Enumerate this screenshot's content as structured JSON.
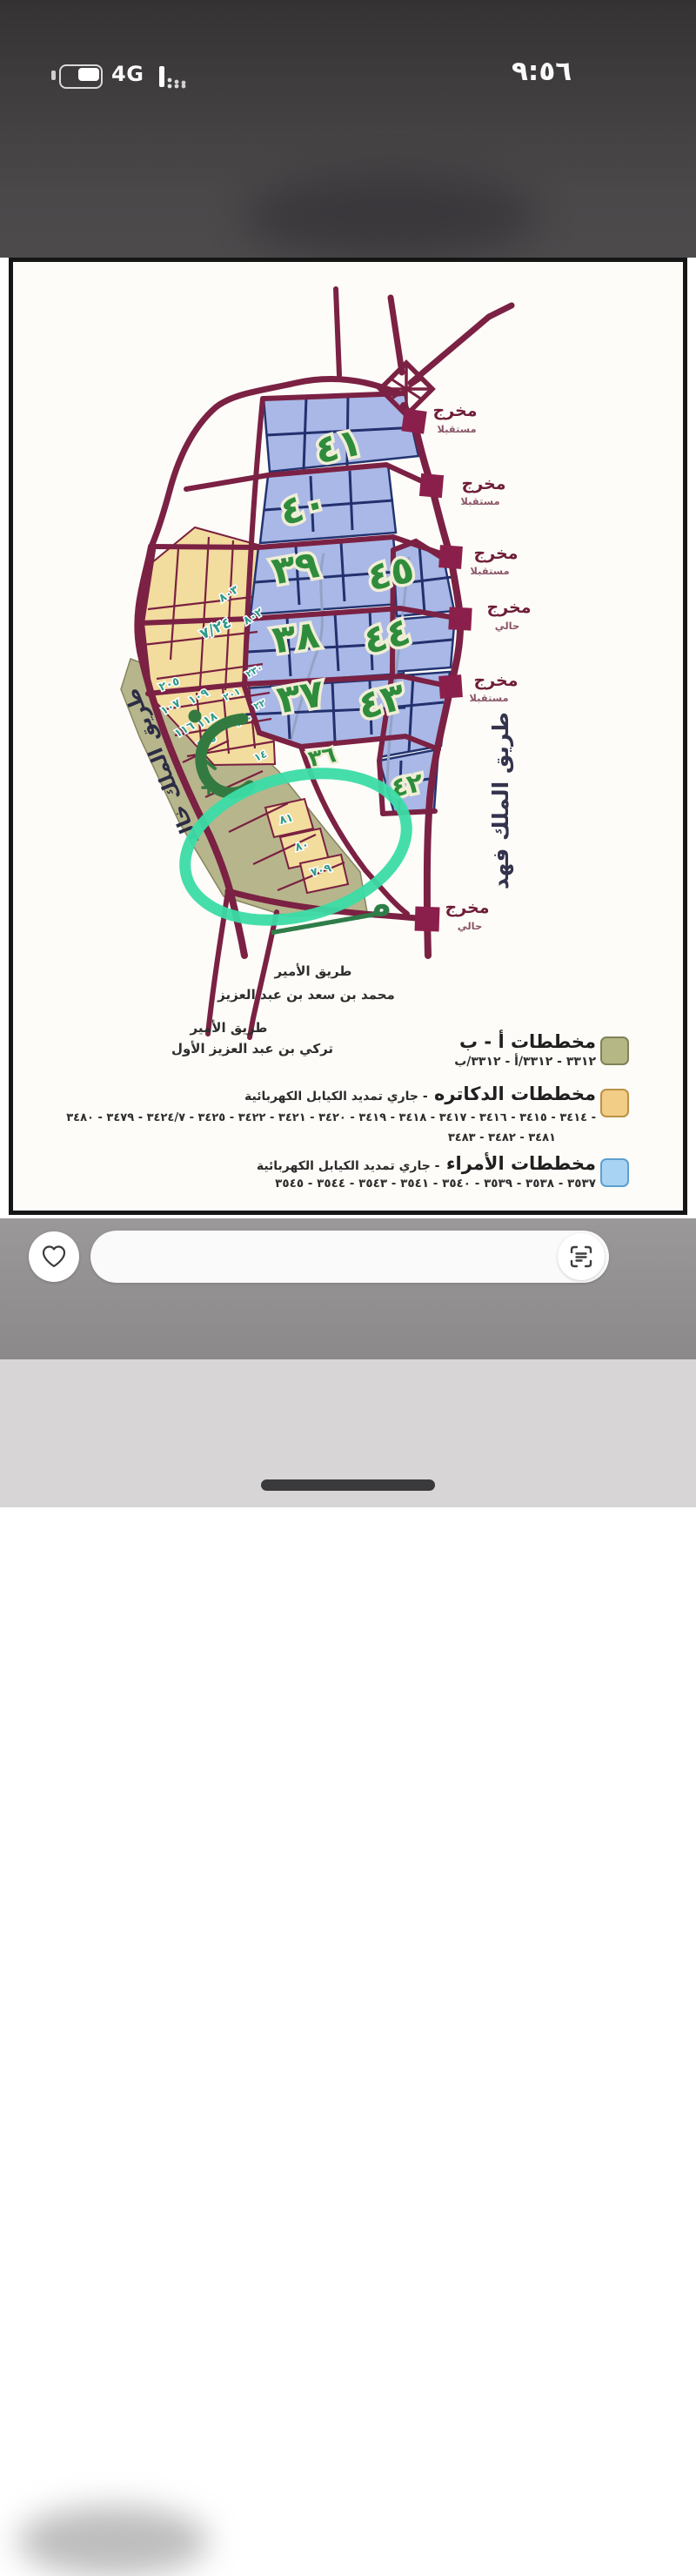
{
  "status_bar": {
    "time": "٩:٥٦",
    "network_label": "4G"
  },
  "map": {
    "exits": [
      {
        "label": "مخرج",
        "sub": "مستقبلا"
      },
      {
        "label": "مخرج",
        "sub": "مستقبلا"
      },
      {
        "label": "مخرج",
        "sub": "مستقبلا"
      },
      {
        "label": "مخرج",
        "sub": "حالي"
      },
      {
        "label": "مخرج",
        "sub": "مستقبلا"
      },
      {
        "label": "مخرج",
        "sub": "حالي"
      }
    ],
    "districts": [
      {
        "label": "٤١"
      },
      {
        "label": "٤٠"
      },
      {
        "label": "٣٩"
      },
      {
        "label": "٣٨"
      },
      {
        "label": "٣٧"
      },
      {
        "label": "٤٥"
      },
      {
        "label": "٤٤"
      },
      {
        "label": "٤٣"
      },
      {
        "label": "٤٢"
      },
      {
        "label": "٣٦"
      }
    ],
    "plots": [
      {
        "label": "٨٠٣"
      },
      {
        "label": "٨٠٢"
      },
      {
        "label": "٧/٢٤"
      },
      {
        "label": "٢٣٠"
      },
      {
        "label": "٢٠٥"
      },
      {
        "label": "٢٠١"
      },
      {
        "label": "١٠٩"
      },
      {
        "label": "١٠٧"
      },
      {
        "label": "١١٨"
      },
      {
        "label": "١١٦"
      },
      {
        "label": "١١٥"
      },
      {
        "label": "٢٢"
      },
      {
        "label": "٢٠٠"
      },
      {
        "label": "١٤"
      },
      {
        "label": "٨١"
      },
      {
        "label": "٨٠"
      },
      {
        "label": "٧٠٩"
      }
    ],
    "roads": {
      "king_fahd": "طريق الملك فهد",
      "king_khalid": "طريق الملك خالد",
      "prince_mohammed_line1": "طريق الأمير",
      "prince_mohammed_line2": "محمد بن سعد بن عبد العزيز",
      "prince_turki_line1": "طريق الأمير",
      "prince_turki_line2": "تركي بن عبد العزيز الأول"
    },
    "zone_ab_glyph": "٦٠",
    "annotation": {
      "meem_text": "مــــــــ"
    },
    "legend": [
      {
        "title": "مخططات أ - ب",
        "subtitle": "",
        "numbers_line1": "٣٣١٢ - ٣٣١٢/أ - ٣٣١٢/ب",
        "numbers_line2": "",
        "color": "#b5b784"
      },
      {
        "title": "مخططات الدكاتره",
        "subtitle": "- جاري تمديد الكيابل الكهربائية",
        "numbers_line1": "٣٤١٤ - ٣٤١٥ - ٣٤١٦ - ٣٤١٧ - ٣٤١٨ - ٣٤١٩ - ٣٤٢٠ - ٣٤٢١ - ٣٤٢٢ - ٣٤٢٥ - ٣٤٢٤/٧ - ٣٤٧٩ - ٣٤٨٠ -",
        "numbers_line2": "٣٤٨١ - ٣٤٨٢ - ٣٤٨٣",
        "color": "#f2cd85"
      },
      {
        "title": "مخططات الأمراء",
        "subtitle": "- جاري تمديد الكيابل الكهربائية",
        "numbers_line1": "٣٥٣٧ - ٣٥٣٨ - ٣٥٣٩ - ٣٥٤٠ - ٣٥٤١ - ٣٥٤٣ - ٣٥٤٤ - ٣٥٤٥",
        "numbers_line2": "",
        "color": "#a9d3f3"
      }
    ]
  },
  "colors": {
    "road": "#7b2143",
    "blue_zone": "#a9b8e6",
    "yellow_zone": "#f2dc9e",
    "olive_zone": "#b7b58c",
    "district_green": "#2f8c3c",
    "annotation_green": "#3bdca6",
    "exit_marker": "#8b1f4b"
  }
}
